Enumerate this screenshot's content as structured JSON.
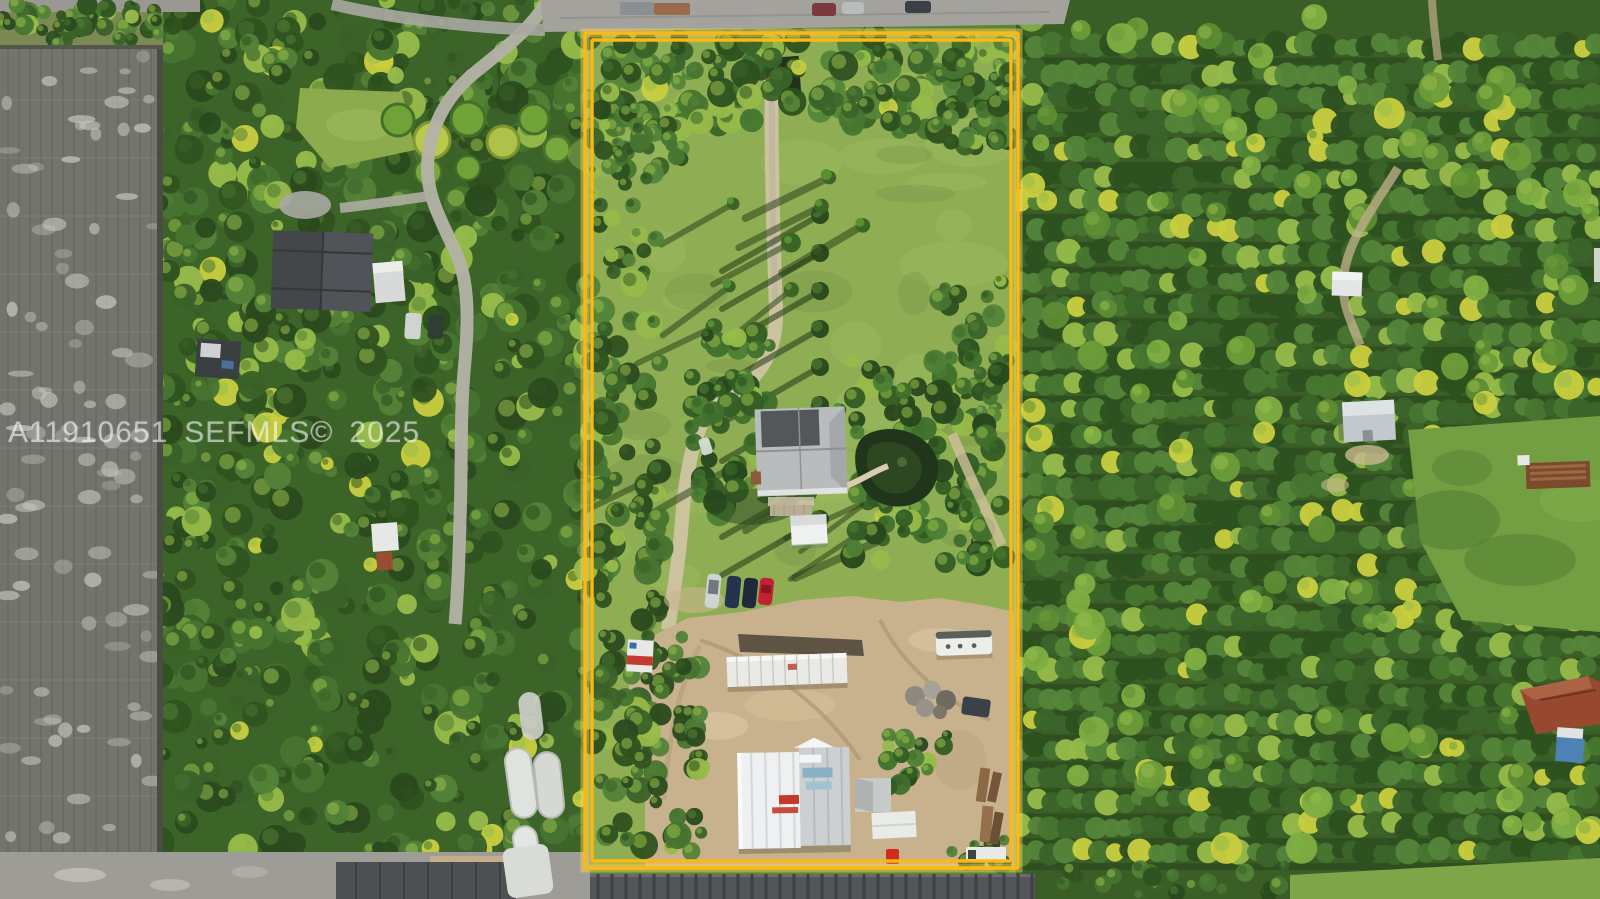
{
  "meta": {
    "type_label": "aerial-photograph",
    "description": "Sunlit aerial drone view of a deep rectangular rural parcel outlined with a double yellow boundary line. Inside the boundary: a grassy field with a straight palm-lined driveway, a gray-roofed house with a pond, and a dirt work-yard with a semi trailer, white warehouse buildings and an RV. Left of the parcel: a large gray shade-house nursery and a wooded neighbor lot with a dark-roofed home. Right of the parcel: dense orchard grove rows, a small gray shed, and a lawn with a red-brown roofed house."
  },
  "watermark": {
    "listing_id": "A11910651",
    "source": "SEFMLS©",
    "year": "2025",
    "full_text": "A11910651 SEFMLS© 2025"
  },
  "colors": {
    "boundary_yellow": "#FDB813",
    "boundary_glow": "#FFDA5E",
    "watermark_text": "rgba(255,255,255,0.55)",
    "grass_field": "#8FAE54",
    "orchard_green": "#3A5E26",
    "neighbor_woods": "#3D6428",
    "shade_house_gray": "#72746D",
    "dirt_yard": "#C8B28D",
    "warehouse_white": "#EEF0F1",
    "accent_red": "#C23A2C",
    "road_gray": "#A3A29D",
    "barn_roof": "#53555A"
  },
  "scene": {
    "landmarks": [
      {
        "name": "property-boundary",
        "desc": "double yellow rectangle outlining the listed parcel"
      },
      {
        "name": "main-house",
        "desc": "gray hip-roof house at center of parcel"
      },
      {
        "name": "detached-shed",
        "desc": "small white shed south of house"
      },
      {
        "name": "pond",
        "desc": "dark tropical pond east of house"
      },
      {
        "name": "driveway",
        "desc": "long straight drive from road to homestead"
      },
      {
        "name": "parked-vehicles",
        "desc": "row of boats/SUVs and a red car on the grass"
      },
      {
        "name": "semi-trailer",
        "desc": "long white trailer in dirt yard"
      },
      {
        "name": "warehouse",
        "desc": "white and gray metal warehouse buildings with red doors"
      },
      {
        "name": "rv-trailer",
        "desc": "white RV parked near east boundary"
      },
      {
        "name": "shade-house",
        "desc": "large gray nursery shade structure west of parcel"
      },
      {
        "name": "neighbor-house",
        "desc": "dark roofed neighboring home among trees"
      },
      {
        "name": "orchard-rows",
        "desc": "dense grove rows east of parcel"
      },
      {
        "name": "access-road",
        "desc": "paved road along the top edge"
      },
      {
        "name": "barn-roof",
        "desc": "long dark ribbed roof along bottom edge"
      }
    ]
  }
}
